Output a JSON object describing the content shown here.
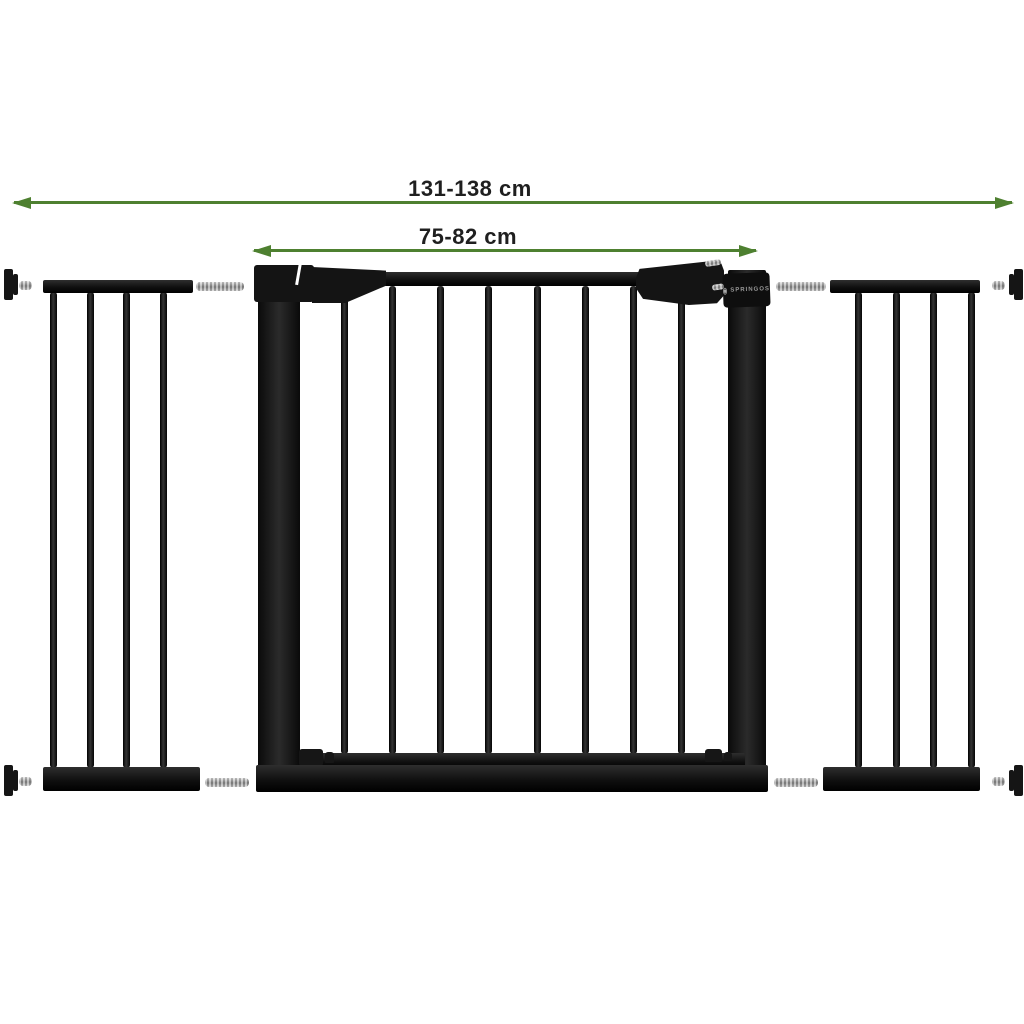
{
  "image_type": "product-dimension-diagram",
  "brand": {
    "name": "SPRINGOS",
    "logo_icon": "springos-circle-mark"
  },
  "dimensions": {
    "total_width_label": "131-138 cm",
    "gate_width_label": "75-82 cm"
  },
  "product": {
    "description": "black metal pressure-mounted safety gate with door and two extension panels",
    "parts": {
      "left_extension_bars": 4,
      "door_bars": 8,
      "right_extension_bars": 4,
      "wall_spindle_knobs": 4,
      "extension_connector_pins": 4
    }
  },
  "colors": {
    "arrow_green": "#4e8030",
    "label_text": "#1f1f1f",
    "gate_black": "#151515",
    "metal_silver": "#b5b5b5",
    "background": "#ffffff"
  }
}
